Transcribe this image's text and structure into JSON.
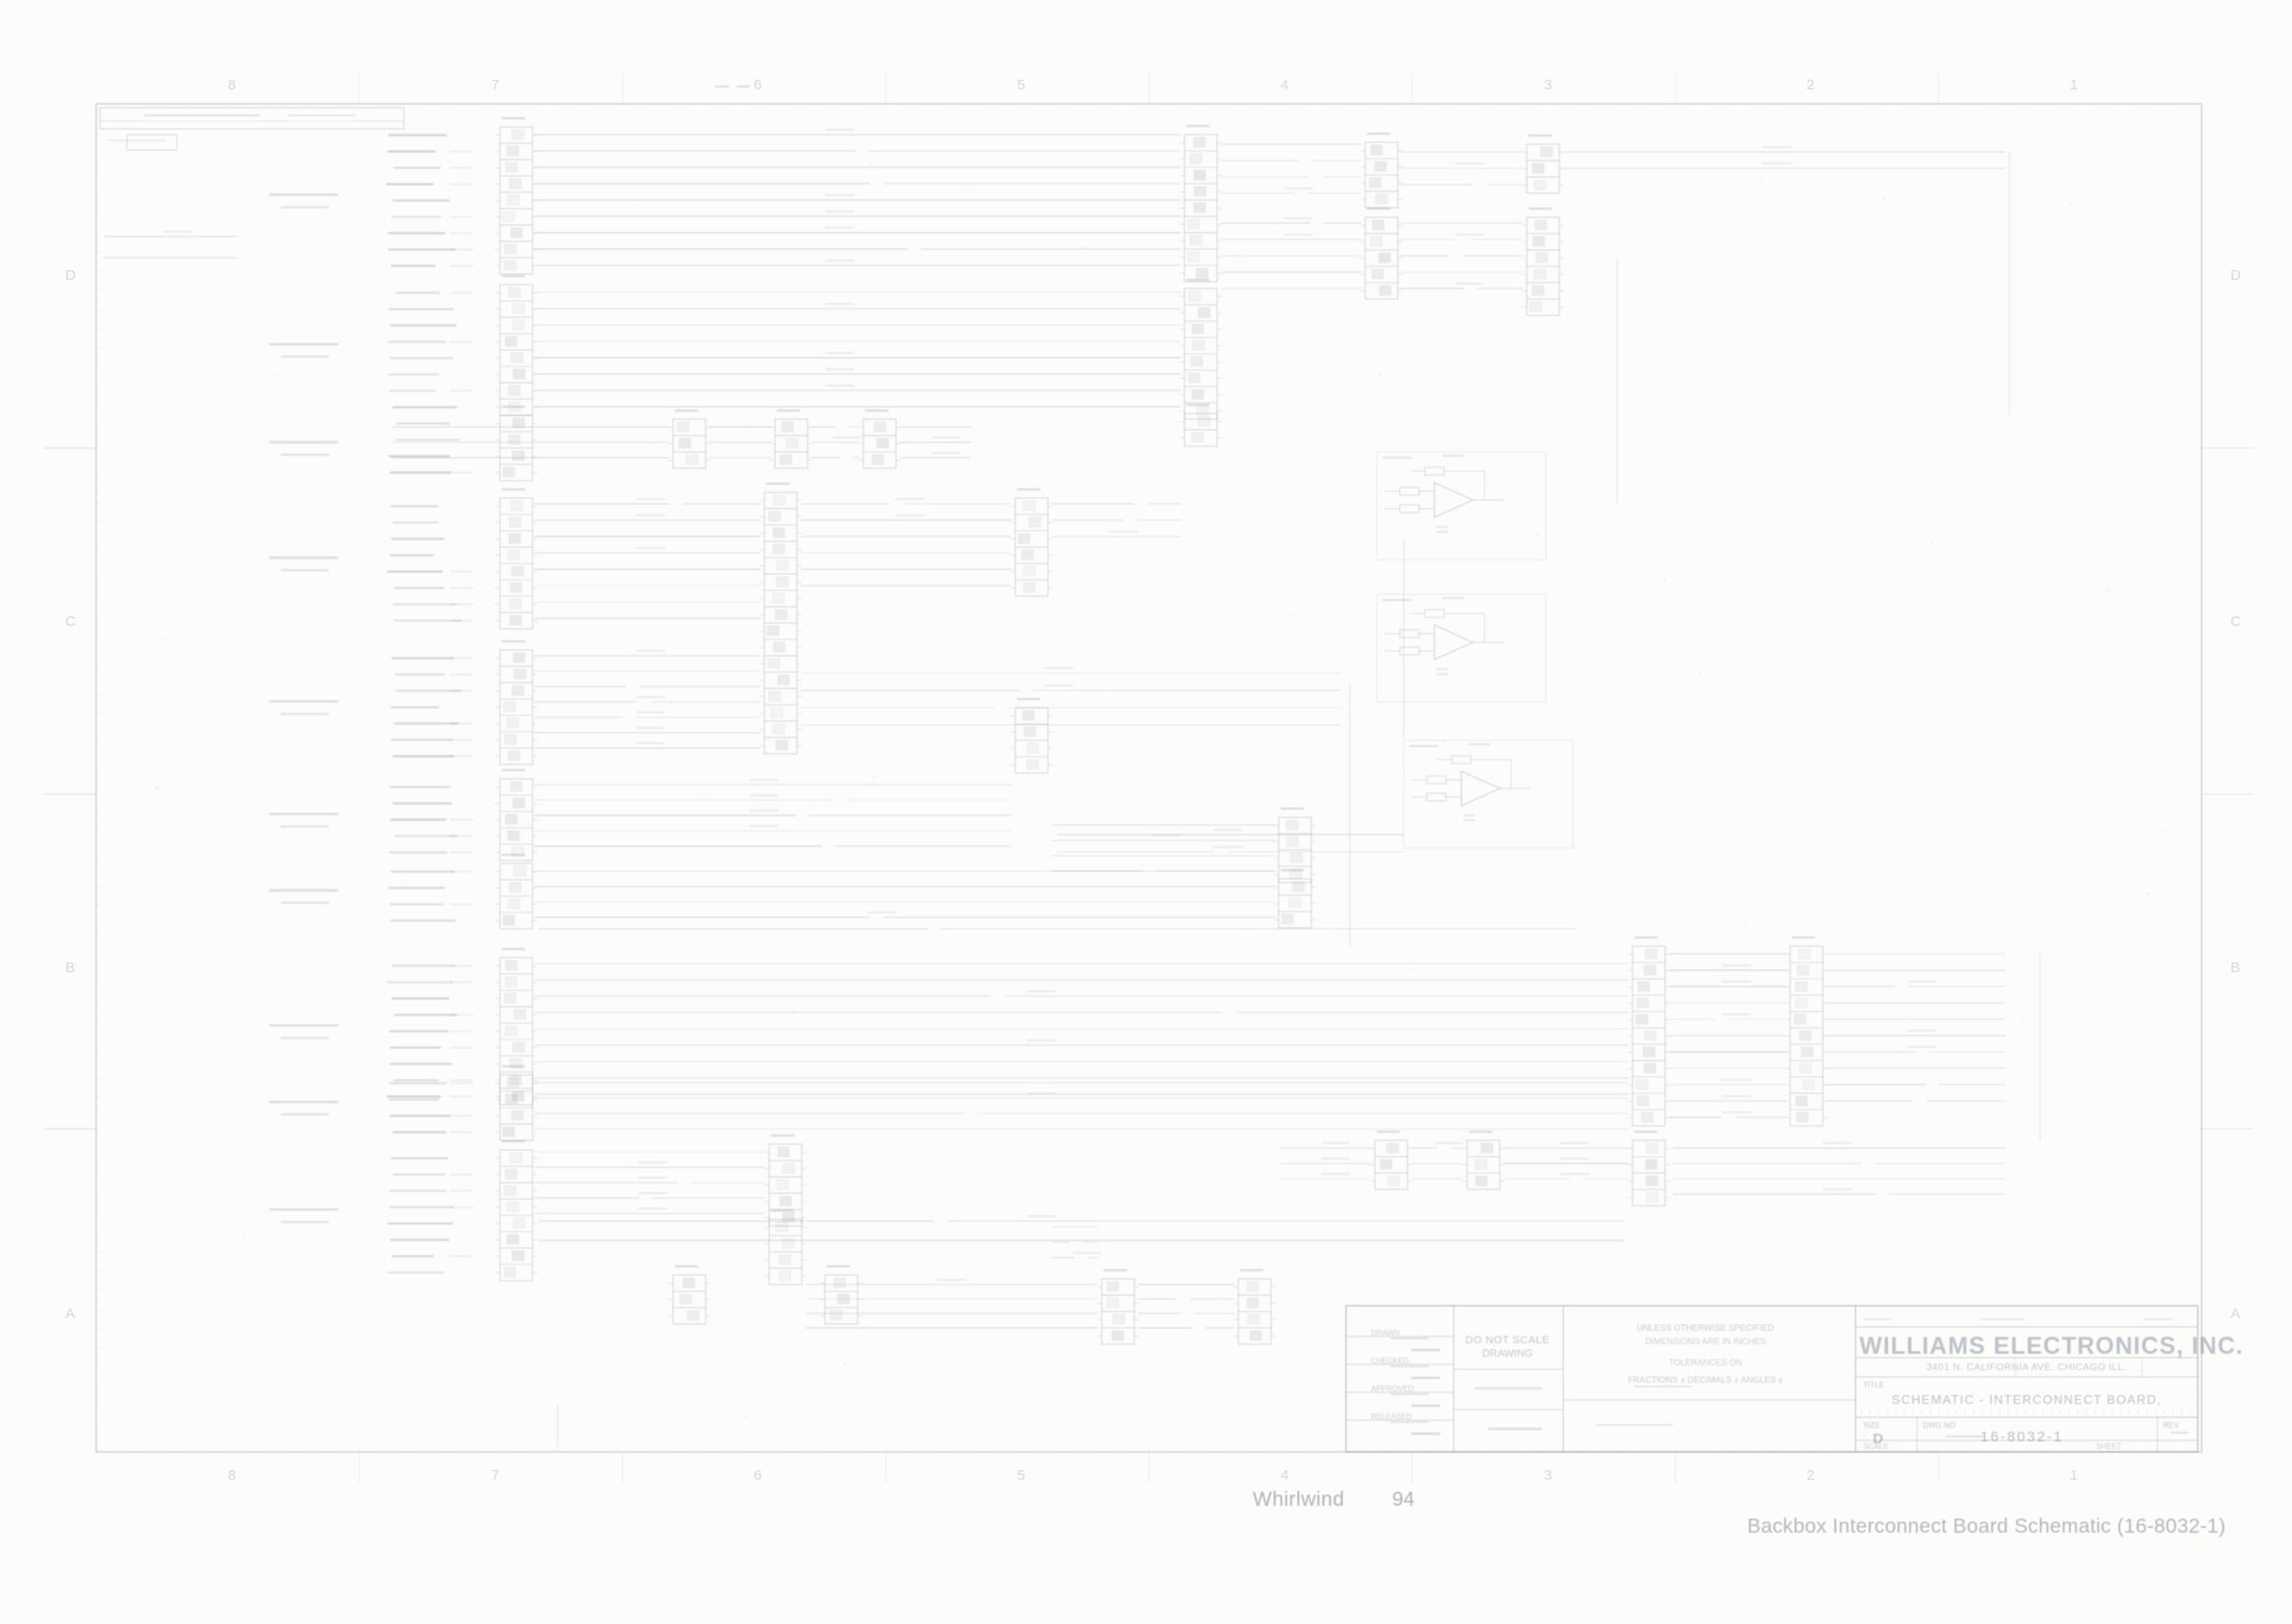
{
  "footer": {
    "game": "Whirlwind",
    "page": "94",
    "caption": "Backbox Interconnect Board Schematic (16-8032-1)"
  },
  "title_block": {
    "company": "WILLIAMS ELECTRONICS, INC.",
    "address": "3401 N. CALIFORNIA AVE.      CHICAGO      ILL.",
    "title_label": "TITLE",
    "drawing_title": "SCHEMATIC - INTERCONNECT BOARD,",
    "do_not_scale_1": "DO NOT SCALE",
    "do_not_scale_2": "DRAWING",
    "tolerance_header": "UNLESS OTHERWISE SPECIFIED",
    "tolerance_line2": "DIMENSIONS ARE IN INCHES",
    "tolerance_line3": "TOLERANCES ON",
    "tolerance_line4": "FRACTIONS ±   DECIMALS ±   ANGLES ±",
    "size_label": "SIZE",
    "size_value": "D",
    "dwg_label": "DWG NO",
    "dwg_value": "16-8032-1",
    "rev_label": "REV",
    "scale_label": "SCALE",
    "sheet_label": "SHEET",
    "approvals": [
      "DRAWN",
      "CHECKED",
      "APPROVED",
      "RELEASED"
    ]
  },
  "zones": {
    "rows": [
      "D",
      "C",
      "B",
      "A"
    ],
    "cols": [
      "8",
      "7",
      "6",
      "5",
      "4",
      "3",
      "2",
      "1"
    ]
  },
  "colors": {
    "ink": "#76837d",
    "text_ink": "#6c7783",
    "background": "#fcfcfb"
  }
}
